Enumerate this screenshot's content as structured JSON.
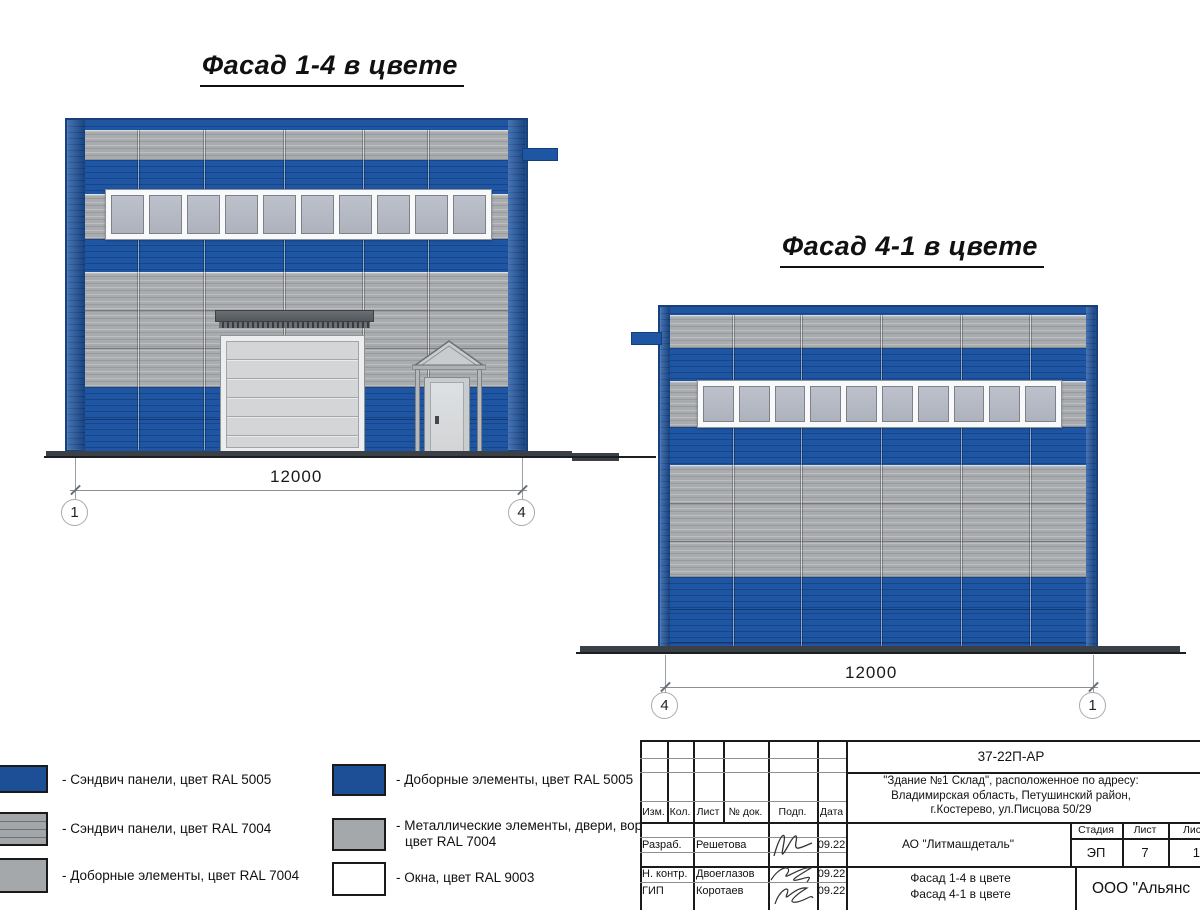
{
  "facade_14": {
    "title": "Фасад 1-4 в цвете",
    "dimension": "12000",
    "axis_left": "1",
    "axis_right": "4",
    "window_panes": 10
  },
  "facade_41": {
    "title": "Фасад 4-1 в цвете",
    "dimension": "12000",
    "axis_left": "4",
    "axis_right": "1",
    "window_panes": 10
  },
  "colors": {
    "ral5005_blue": "#1d4f96",
    "ral7004_gray": "#a5a8ab",
    "ral9003_white": "#ffffff",
    "facade_blue": "#1e56a4",
    "facade_gray": "#a9acaf",
    "window_glass": "#b2b6c1"
  },
  "legend": {
    "left": [
      {
        "label": "- Сэндвич панели, цвет RAL 5005"
      },
      {
        "label": "- Сэндвич панели, цвет RAL 7004"
      },
      {
        "label": "- Доборные элементы, цвет RAL 7004"
      }
    ],
    "right": [
      {
        "label": "- Доборные элементы, цвет RAL 5005"
      },
      {
        "label": "- Металлические элементы, двери, ворота,",
        "label2": "цвет RAL 7004"
      },
      {
        "label": "- Окна, цвет RAL 9003"
      }
    ]
  },
  "titleblock": {
    "doc_number": "37-22П-АР",
    "address_line1": "\"Здание №1 Склад\", расположенное по адресу:",
    "address_line2": "Владимирская область, Петушинский район,",
    "address_line3": "г.Костерево, ул.Писцова 50/29",
    "cols": {
      "izm": "Изм.",
      "kol": "Кол.",
      "list": "Лист",
      "doc": "№ док.",
      "podp": "Подп.",
      "data": "Дата"
    },
    "rows": [
      {
        "role": "Разраб.",
        "name": "Решетова",
        "date": "09.22"
      },
      {
        "role": "Н. контр.",
        "name": "Двоеглазов",
        "date": "09.22"
      },
      {
        "role": "ГИП",
        "name": "Коротаев",
        "date": "09.22"
      }
    ],
    "client": "АО \"Литмашдеталь\"",
    "stage_label": "Стадия",
    "sheet_label": "Лист",
    "sheets_label": "Листов",
    "stage": "ЭП",
    "sheet": "7",
    "sheets": "14",
    "sheet_title_line1": "Фасад 1-4 в цвете",
    "sheet_title_line2": "Фасад 4-1 в цвете",
    "company": "ООО \"Альянс"
  }
}
